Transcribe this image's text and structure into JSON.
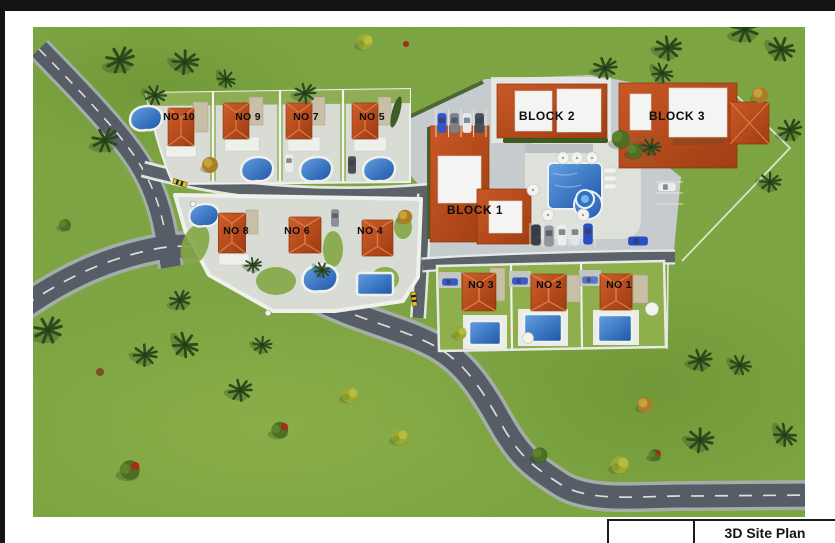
{
  "title_block": {
    "label": "3D Site Plan",
    "left_cell": ""
  },
  "site_plan": {
    "description": "3D rendered site plan of a residential development",
    "villas": [
      {
        "id": "no-10",
        "label": "NO 10"
      },
      {
        "id": "no-9",
        "label": "NO 9"
      },
      {
        "id": "no-7",
        "label": "NO 7"
      },
      {
        "id": "no-5",
        "label": "NO 5"
      },
      {
        "id": "no-8",
        "label": "NO 8"
      },
      {
        "id": "no-6",
        "label": "NO 6"
      },
      {
        "id": "no-4",
        "label": "NO 4"
      },
      {
        "id": "no-3",
        "label": "NO 3"
      },
      {
        "id": "no-2",
        "label": "NO 2"
      },
      {
        "id": "no-1",
        "label": "NO 1"
      }
    ],
    "blocks": [
      {
        "id": "block-1",
        "label": "BLOCK 1"
      },
      {
        "id": "block-2",
        "label": "BLOCK 2"
      },
      {
        "id": "block-3",
        "label": "BLOCK 3"
      }
    ],
    "colors": {
      "grass": "#7aa23d",
      "road": "#575d66",
      "roof": "#bf4f1e",
      "pool": "#2e73c5",
      "hardscape": "#d8dcd4",
      "frame": "#141414"
    }
  }
}
